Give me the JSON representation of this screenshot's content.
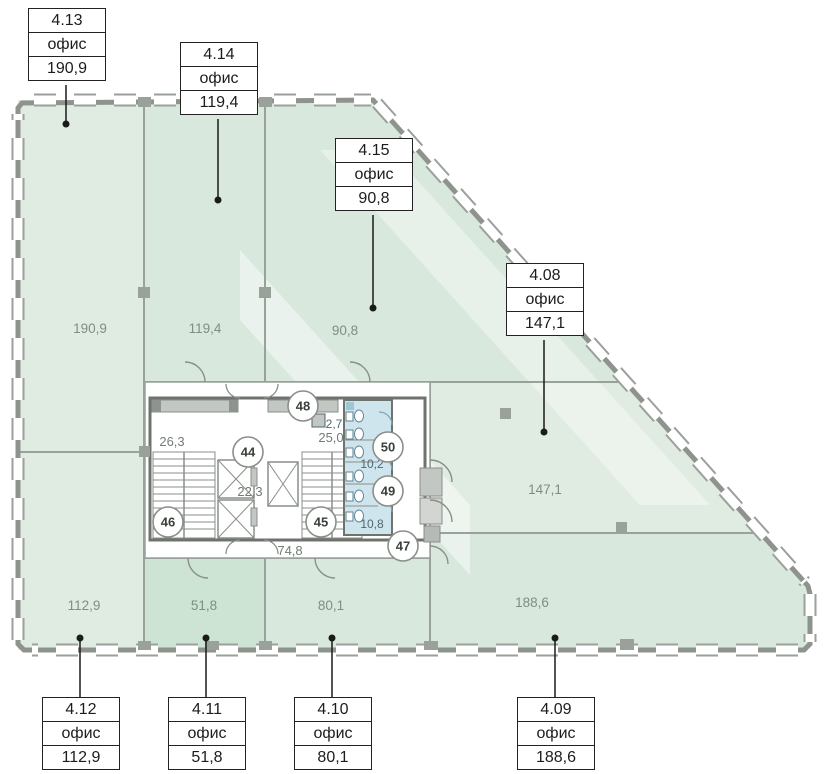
{
  "units": [
    {
      "id": "4.13",
      "type": "офис",
      "area": "190,9"
    },
    {
      "id": "4.14",
      "type": "офис",
      "area": "119,4"
    },
    {
      "id": "4.15",
      "type": "офис",
      "area": "90,8"
    },
    {
      "id": "4.08",
      "type": "офис",
      "area": "147,1"
    },
    {
      "id": "4.12",
      "type": "офис",
      "area": "112,9"
    },
    {
      "id": "4.11",
      "type": "офис",
      "area": "51,8"
    },
    {
      "id": "4.10",
      "type": "офис",
      "area": "80,1"
    },
    {
      "id": "4.09",
      "type": "офис",
      "area": "188,6"
    }
  ],
  "core": {
    "areas": {
      "stair_left": "26,3",
      "stair_right": "25,0",
      "lobby": "22,3",
      "corridor": "74,8",
      "storage": "2,7",
      "wc_upper": "10,2",
      "wc_lower": "10,8"
    },
    "markers": {
      "m44": "44",
      "m45": "45",
      "m46": "46",
      "m47": "47",
      "m48": "48",
      "m49": "49",
      "m50": "50"
    }
  },
  "colors": {
    "room_pale_green": "#e0ebe1",
    "room_mid_green": "#d8e8dc",
    "room_dark_green": "#cde3d4",
    "wc_blue": "#cfe5ee",
    "facade_gray": "#8e938e",
    "core_wall_gray": "#6e736e",
    "partition_gray": "#98a29b",
    "area_label": "#7e8e84",
    "callout_border": "#222222"
  }
}
